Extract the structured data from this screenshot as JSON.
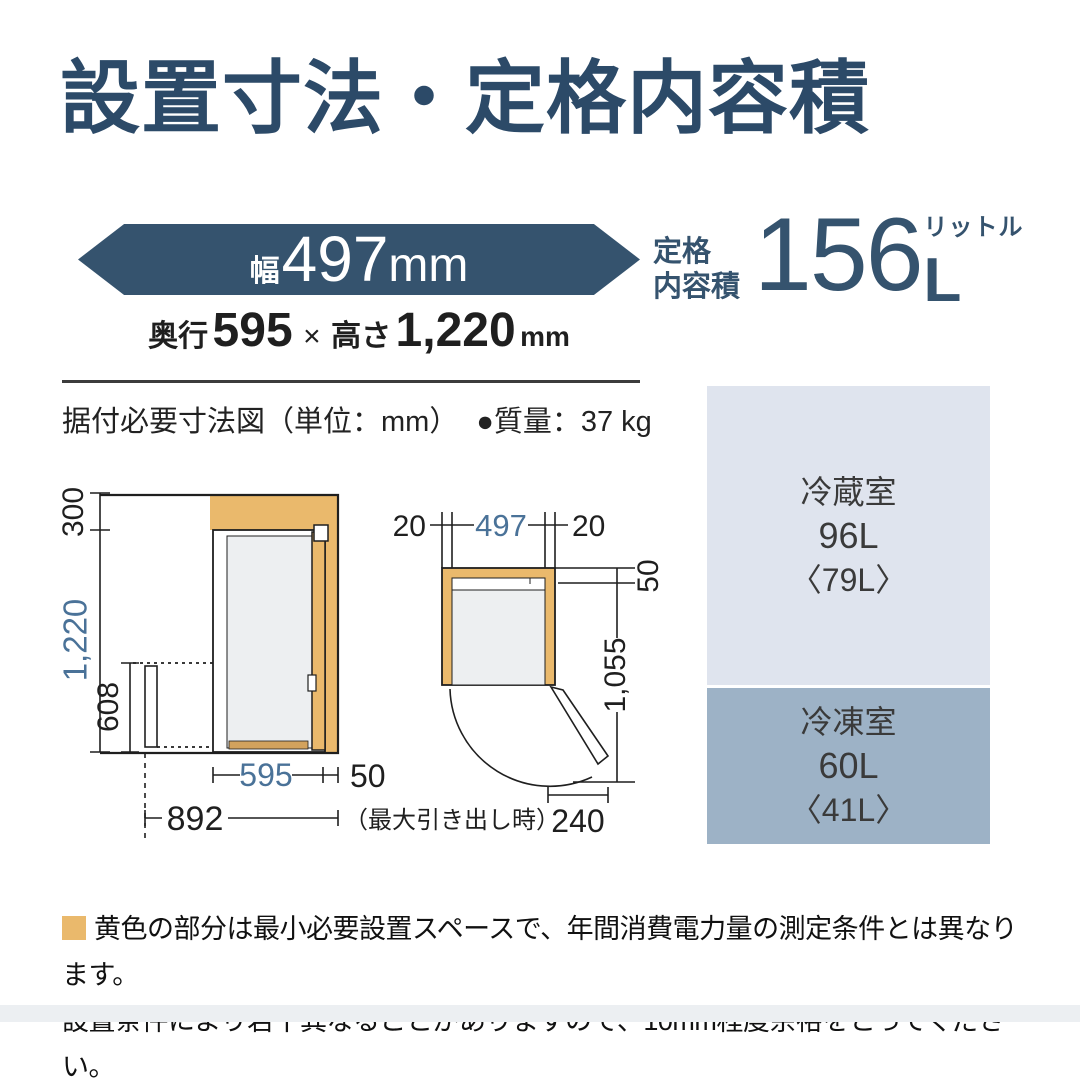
{
  "colors": {
    "navy": "#35536e",
    "title_navy": "#2c4a68",
    "dimension_blue": "#4a7298",
    "clearance_orange": "#eab96c",
    "fridge_box_bg": "#dfe4ee",
    "freezer_box_bg": "#9db2c6"
  },
  "title": "設置寸法・定格内容積",
  "size_banner": {
    "width_prefix": "幅",
    "width_value": "497",
    "width_unit": "mm"
  },
  "depth_height": {
    "depth_label": "奥行",
    "depth_value": "595",
    "multiply": "×",
    "height_label": "高さ",
    "height_value": "1,220",
    "unit": "mm"
  },
  "rated_capacity": {
    "label_line1": "定格",
    "label_line2": "内容積",
    "value": "156",
    "unit": "L",
    "unit_ruby": "リットル"
  },
  "diagram_caption": {
    "text": "据付必要寸法図（単位：mm）",
    "mass": "●質量：37 kg"
  },
  "side_view": {
    "top_clearance": "300",
    "height": "1,220",
    "drawer_height": "608",
    "depth": "595",
    "rear_clearance": "50",
    "max_pullout_depth": "892",
    "max_pullout_note": "（最大引き出し時）"
  },
  "top_view": {
    "left_clearance": "20",
    "width": "497",
    "right_clearance": "20",
    "rear_clearance": "50",
    "open_depth": "1,055",
    "door_projection": "240"
  },
  "compartments": [
    {
      "name": "冷蔵室",
      "capacity": "96L",
      "sub_capacity": "〈79L〉"
    },
    {
      "name": "冷凍室",
      "capacity": "60L",
      "sub_capacity": "〈41L〉"
    }
  ],
  "footnote": {
    "line1": "黄色の部分は最小必要設置スペースで、年間消費電力量の測定条件とは異なります。",
    "line2": "設置条件により若干異なることがありますので、10mm程度余裕をとってください。"
  }
}
